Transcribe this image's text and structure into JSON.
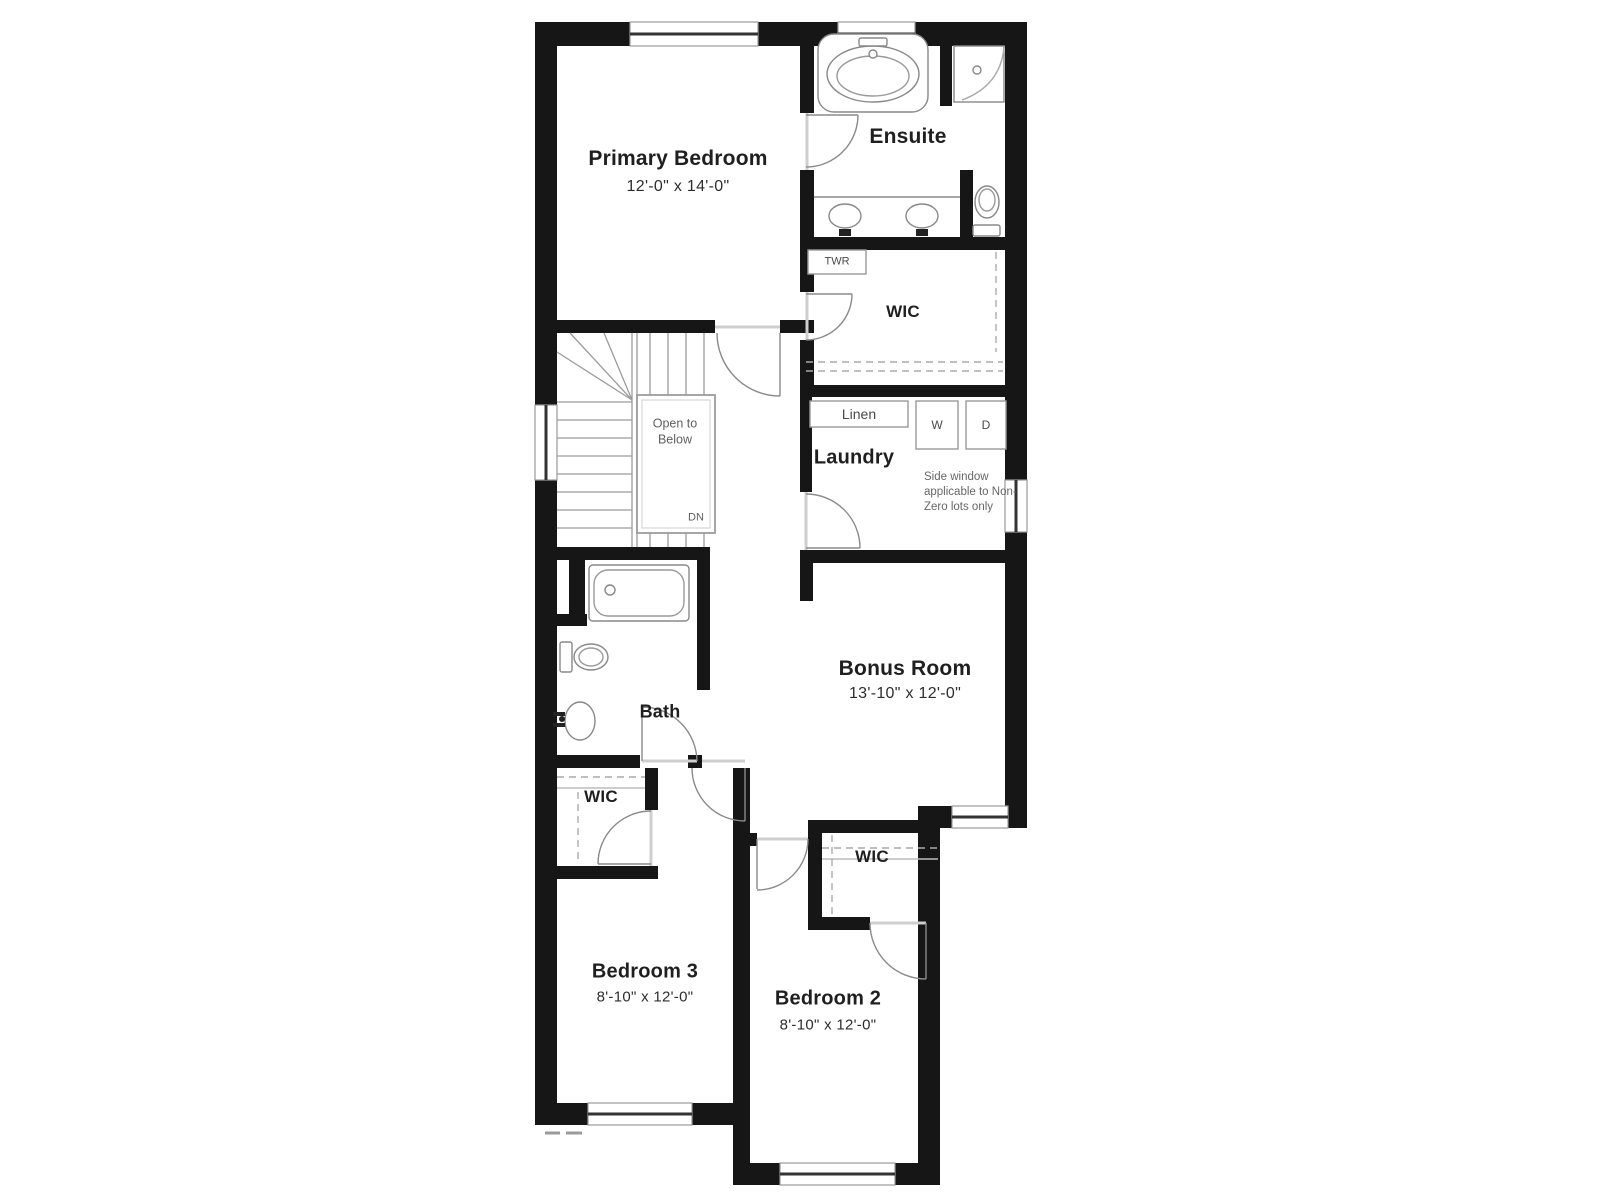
{
  "plan": {
    "type": "floor-plan",
    "colors": {
      "wall": "#161616",
      "line": "#8a8a8a",
      "text": "#1f1f1f",
      "muted": "#666666"
    }
  },
  "rooms": {
    "primary_bedroom": {
      "label": "Primary Bedroom",
      "dims": "12'-0\" x 14'-0\""
    },
    "ensuite": {
      "label": "Ensuite"
    },
    "wic_primary": {
      "label": "WIC"
    },
    "laundry": {
      "label": "Laundry"
    },
    "bonus_room": {
      "label": "Bonus Room",
      "dims": "13'-10\" x 12'-0\""
    },
    "bath": {
      "label": "Bath"
    },
    "wic_bedroom3": {
      "label": "WIC"
    },
    "wic_bedroom2": {
      "label": "WIC"
    },
    "bedroom3": {
      "label": "Bedroom 3",
      "dims": "8'-10\" x 12'-0\""
    },
    "bedroom2": {
      "label": "Bedroom 2",
      "dims": "8'-10\" x 12'-0\""
    }
  },
  "fixtures": {
    "towel_label": "TWR",
    "linen_label": "Linen",
    "washer_label": "W",
    "dryer_label": "D"
  },
  "stairs": {
    "open_to_below": "Open to Below",
    "down": "DN"
  },
  "notes": {
    "side_window": "Side window applicable to Non-Zero lots only"
  }
}
